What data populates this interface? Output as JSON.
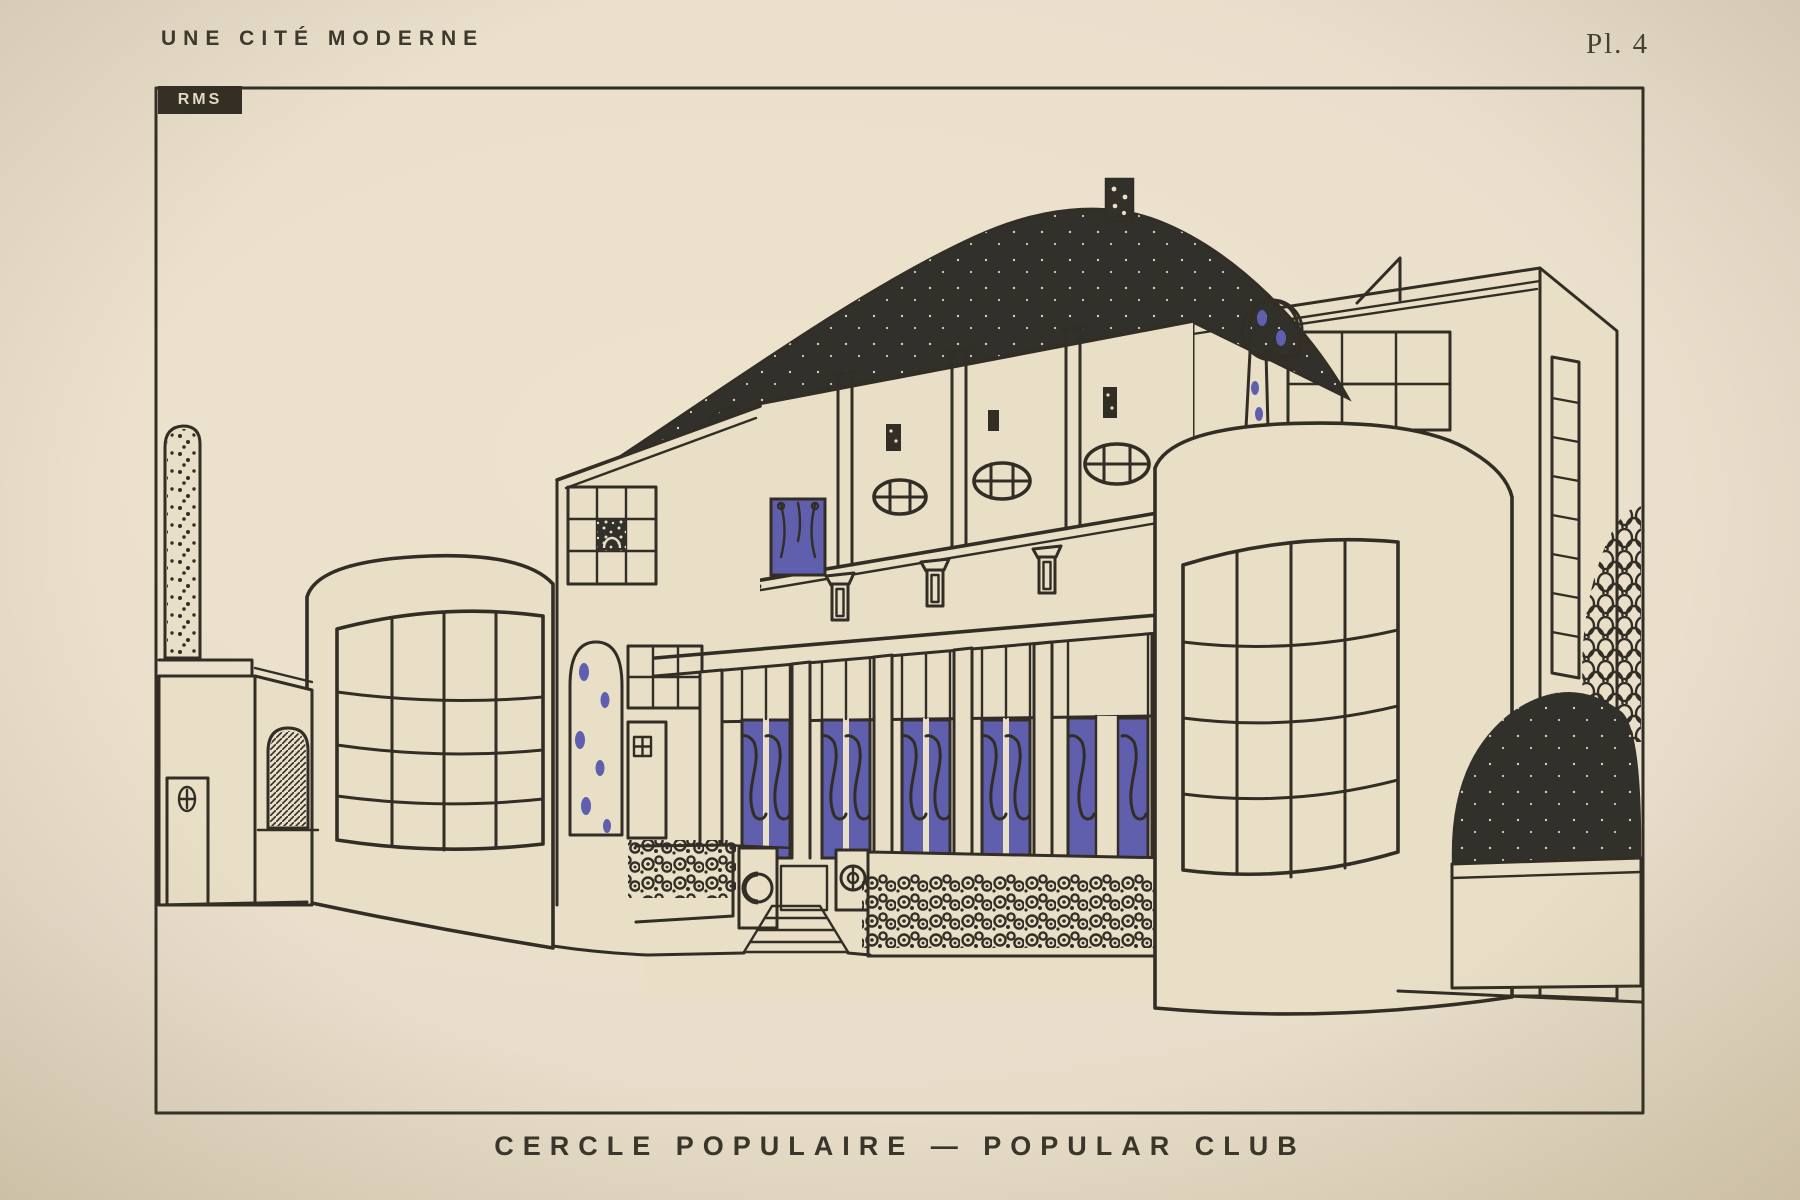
{
  "document": {
    "series_title": "UNE CITÉ MODERNE",
    "plate_number": "Pl. 4",
    "caption_fr": "CERCLE POPULAIRE",
    "caption_en": "POPULAR CLUB",
    "caption_full": "CERCLE POPULAIRE — POPULAR CLUB",
    "monogram": "RMS",
    "colors": {
      "paper": "#e9dfc7",
      "ink": "#322e25",
      "blue": "#5f5fae",
      "domeink": "#32302a"
    },
    "illustration": {
      "type": "architectural plate, line drawing with flat color accents",
      "subject": "Modernist community club building (Cercle Populaire)",
      "elements": [
        "large black low dome with dotted lantern finial",
        "central two-storey hall with pilasters",
        "three oval windows with blue-striped glazing",
        "tall blue window with curtain scrolls",
        "row of small flared niches on the band",
        "ground-floor colonnade with five pairs of blue doors and wrought-iron scrolls",
        "flower planters and dotted entrance panel",
        "entrance steps flanked by pedestals with circle ornaments",
        "left rounded bay with curved gridded window",
        "right rounded bay with curved gridded window",
        "vine-covered pillars and arched vine doorway with blue blossoms",
        "right wing with grid windows and ladder window",
        "garden wall, pebbled stele, small door with oval ornament, hatched bollard",
        "clipped black shrub in planter and honeycomb-pattern tree"
      ]
    }
  }
}
